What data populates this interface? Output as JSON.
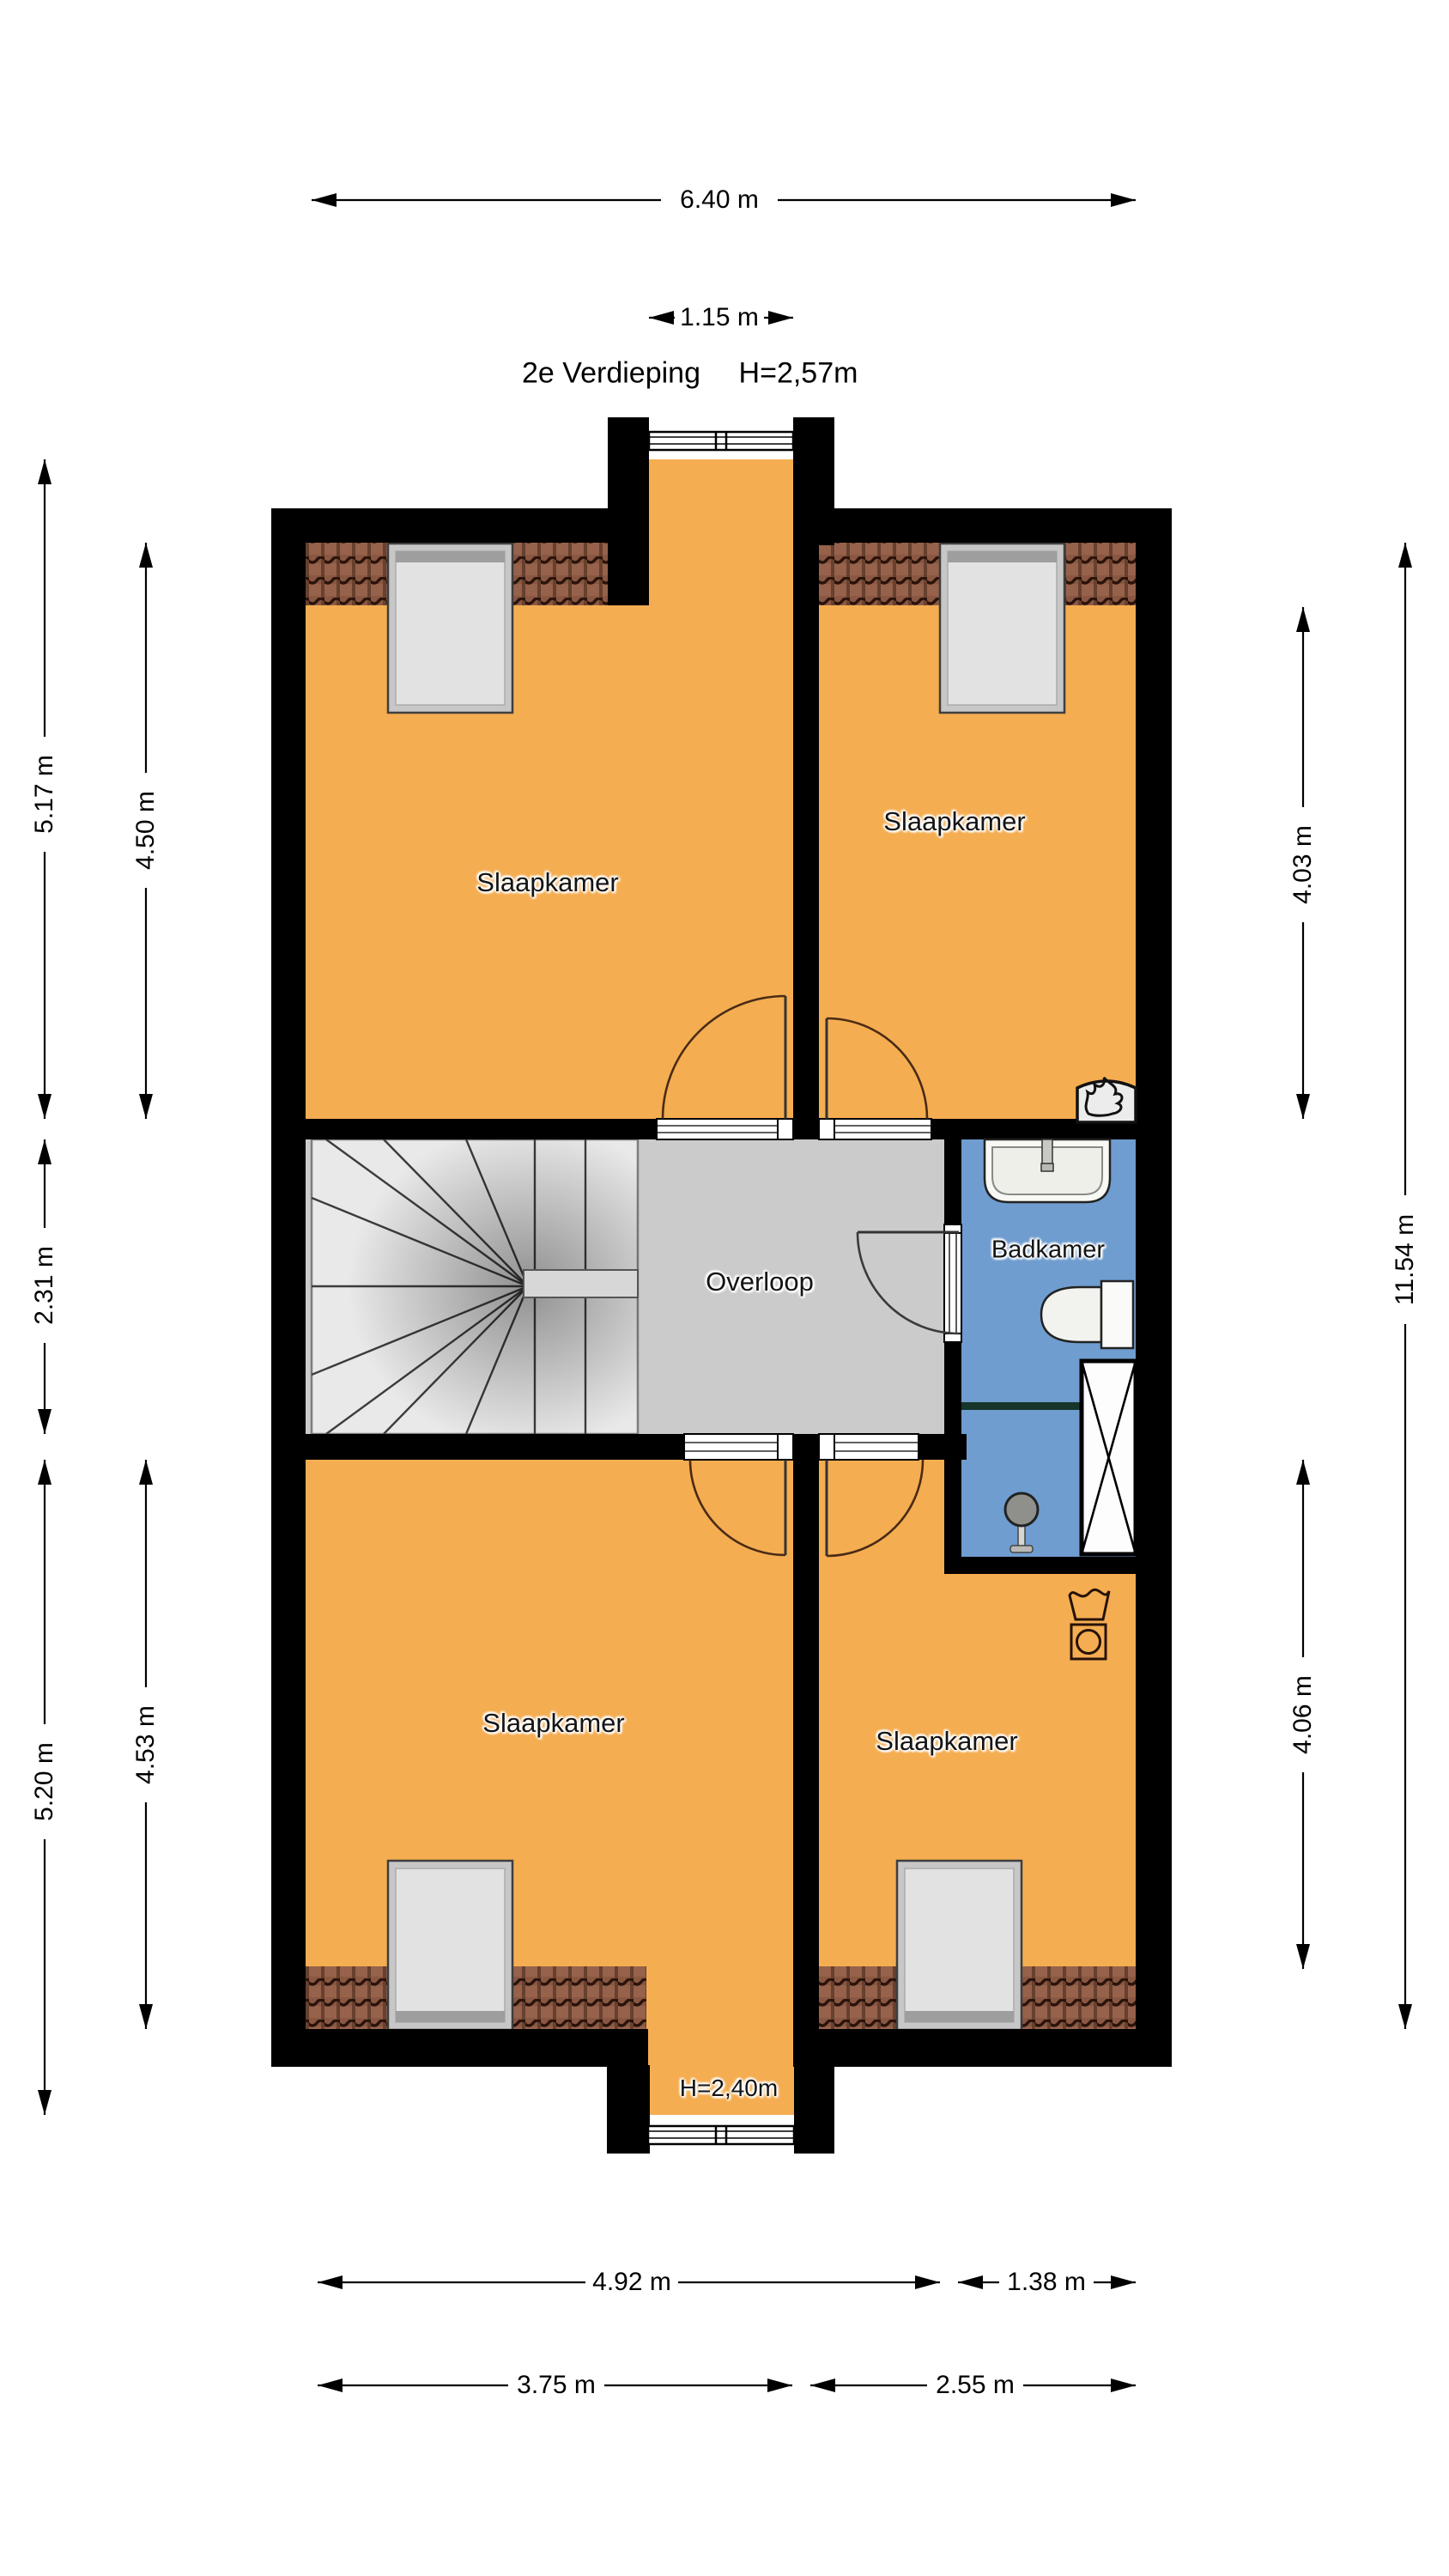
{
  "title": {
    "floor_label": "2e Verdieping",
    "ceiling_height": "H=2,57m"
  },
  "rooms": {
    "bedroom_top_left": {
      "label": "Slaapkamer"
    },
    "bedroom_top_right": {
      "label": "Slaapkamer"
    },
    "bedroom_bottom_left": {
      "label": "Slaapkamer"
    },
    "bedroom_bottom_right": {
      "label": "Slaapkamer"
    },
    "landing": {
      "label": "Overloop"
    },
    "bathroom": {
      "label": "Badkamer"
    },
    "dormer_note": {
      "label": "H=2,40m"
    }
  },
  "dimensions": {
    "overall_width": "6.40 m",
    "dormer_width": "1.15 m",
    "left_outer": {
      "top": "5.17 m",
      "middle": "2.31 m",
      "bottom": "5.20 m"
    },
    "left_inner": {
      "top": "4.50 m",
      "bottom": "4.53 m"
    },
    "right_inner": {
      "top": "4.03 m",
      "bottom": "4.06 m"
    },
    "right_outer": {
      "full": "11.54 m"
    },
    "bottom_outer": {
      "left": "4.92 m",
      "right": "1.38 m"
    },
    "bottom_inner": {
      "left": "3.75 m",
      "right": "2.55 m"
    }
  },
  "icons": {
    "washing_machine": "washing-machine-icon",
    "boiler_flame": "boiler-flame-icon",
    "shower_head": "shower-head-icon",
    "staircase": "staircase-winder",
    "shaft": "shaft-cross"
  },
  "colors": {
    "floor_orange": "#F5AD51",
    "bathroom_blue": "#6F9DD0",
    "landing_grey": "#CBCBCB",
    "stairs_grey": "#E9E9E9",
    "roof_tile_brown": "#8A5742",
    "wall_black": "#000000",
    "fixture_white": "#F8F8F5"
  }
}
